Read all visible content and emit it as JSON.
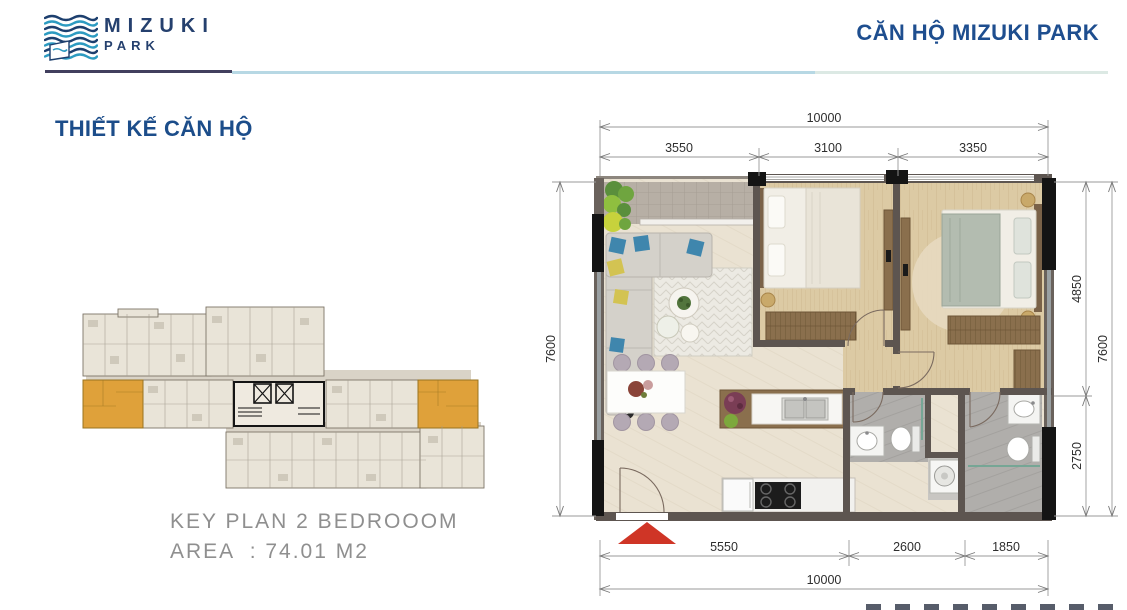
{
  "header": {
    "logo": {
      "title": "MIZUKI",
      "subtitle": "PARK"
    },
    "page_title": "CĂN HỘ MIZUKI PARK"
  },
  "section": {
    "title": "THIẾT KẾ CĂN HỘ"
  },
  "key_plan": {
    "caption_line1": "KEY PLAN 2 BEDROOOM",
    "caption_line2": "AREA  : 74.01 M2",
    "highlight_color": "#DFA13A"
  },
  "floor_plan": {
    "dimensions": {
      "top": {
        "overall": "10000",
        "segments": [
          "3550",
          "3100",
          "3350"
        ]
      },
      "bottom": {
        "overall": "10000",
        "segments": [
          "5550",
          "2600",
          "1850"
        ]
      },
      "left": {
        "overall": "7600"
      },
      "right": {
        "overall": "7600",
        "segments": [
          "4850",
          "2750"
        ]
      }
    }
  },
  "colors": {
    "heading_blue": "#1E4E8F",
    "logo_navy": "#25406E",
    "wave_blue": "#2D9BC1",
    "highlight_orange": "#DFA13A",
    "entrance_red": "#CF3526",
    "caption_gray": "#8F8F8F",
    "wall_gray": "#5D5550"
  }
}
